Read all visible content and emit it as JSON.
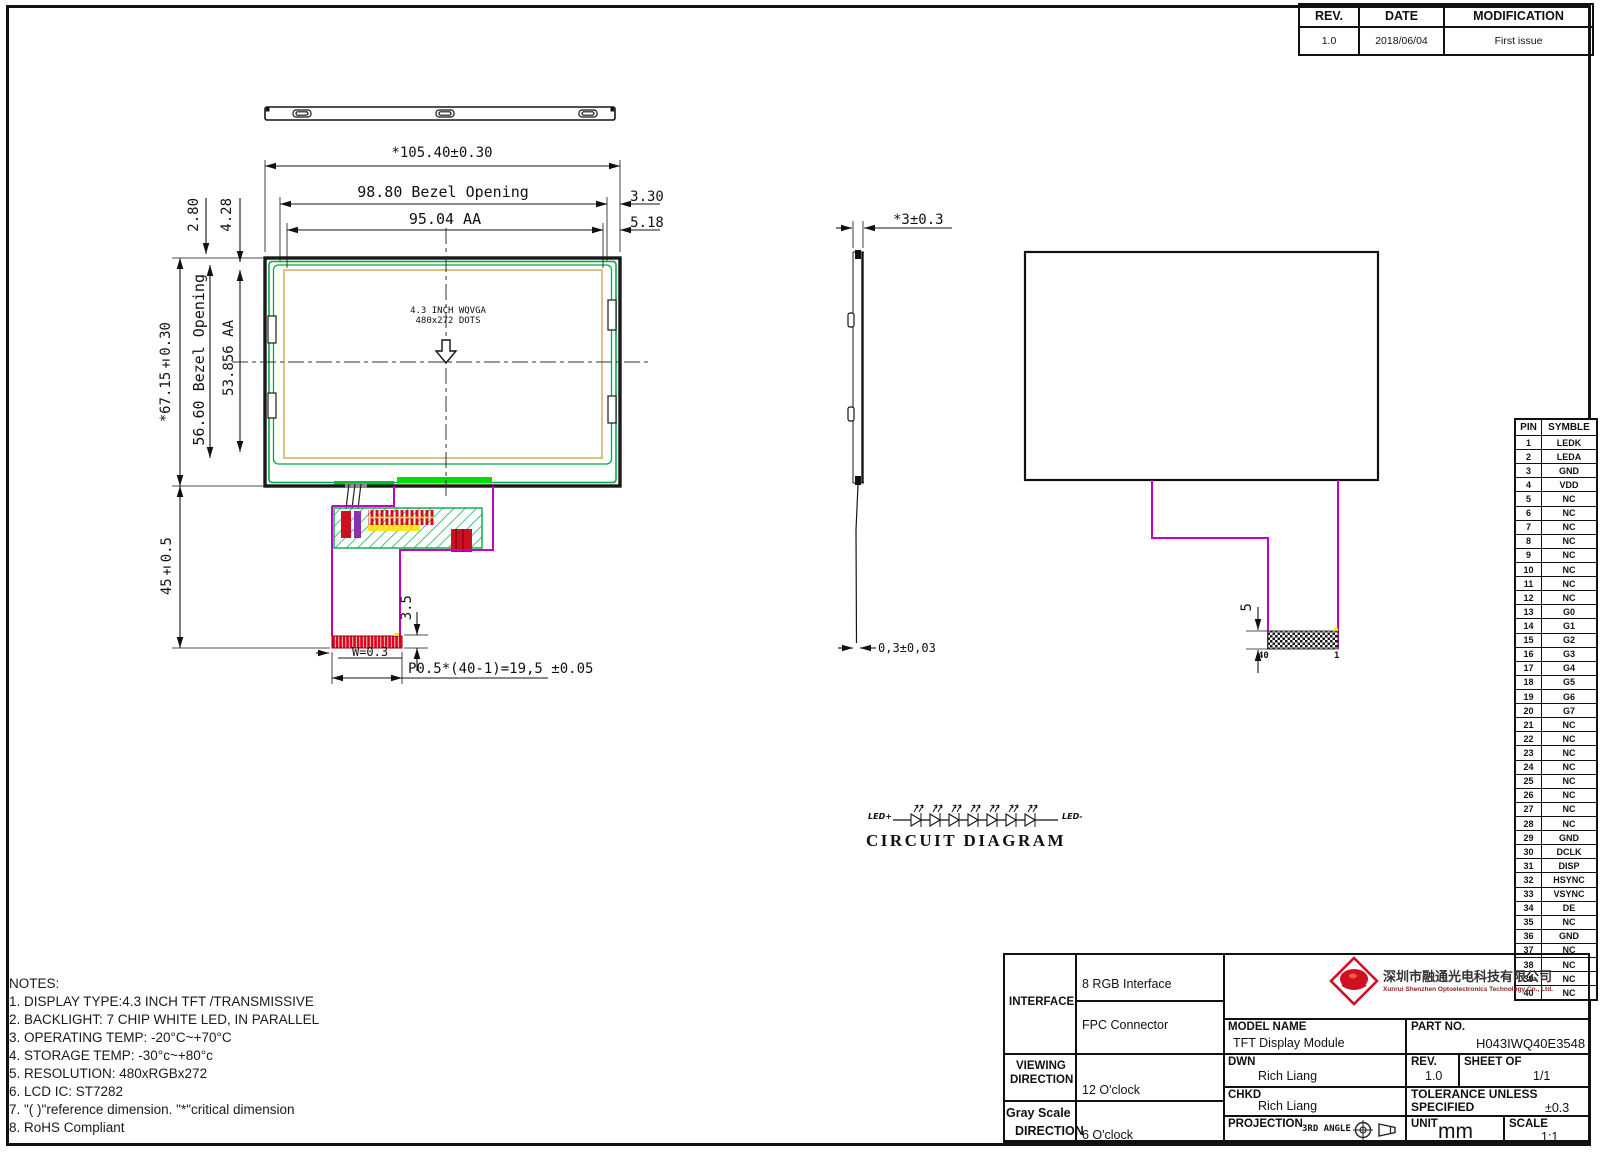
{
  "rev_table": {
    "headers": [
      "REV.",
      "DATE",
      "MODIFICATION"
    ],
    "row": {
      "rev": "1.0",
      "date": "2018/06/04",
      "modification": "First issue"
    }
  },
  "views": {
    "front": {
      "aa_text_line1": "4.3 INCH WQVGA",
      "aa_text_line2": "480x272 DOTS",
      "dim_width_total": "*105.40±0.30",
      "dim_bezel_width": "98.80 Bezel Opening",
      "dim_aa_width": "95.04 AA",
      "dim_right_top": "3.30",
      "dim_right_bottom": "5.18",
      "dim_left_top": "2.80",
      "dim_left_top2": "4.28",
      "dim_height_total": "*67.15±0.30",
      "dim_bezel_height": "56.60 Bezel Opening",
      "dim_aa_height": "53.856 AA",
      "dim_fpc_length": "45±0.5",
      "dim_fpc_tail": "3.5",
      "dim_fpc_width": "W=0.3",
      "dim_fpc_pitch": "P0.5*(40-1)=19,5 ±0.05"
    },
    "side": {
      "dim_thickness": "*3±0.3",
      "dim_fpc_thickness": "0,3±0,03"
    },
    "back": {
      "dim_connector": "5",
      "pin_left": "40",
      "pin_right": "1"
    }
  },
  "pin_table": {
    "headers": [
      "PIN",
      "SYMBLE"
    ],
    "pins": [
      "LEDK",
      "LEDA",
      "GND",
      "VDD",
      "NC",
      "NC",
      "NC",
      "NC",
      "NC",
      "NC",
      "NC",
      "NC",
      "G0",
      "G1",
      "G2",
      "G3",
      "G4",
      "G5",
      "G6",
      "G7",
      "NC",
      "NC",
      "NC",
      "NC",
      "NC",
      "NC",
      "NC",
      "NC",
      "GND",
      "DCLK",
      "DISP",
      "HSYNC",
      "VSYNC",
      "DE",
      "NC",
      "GND",
      "NC",
      "NC",
      "NC",
      "NC"
    ]
  },
  "circuit": {
    "label_left": "LED+",
    "label_right": "LED-",
    "title": "CIRCUIT DIAGRAM",
    "led_count": 7
  },
  "notes": {
    "title": "NOTES:",
    "items": [
      "1. DISPLAY TYPE:4.3 INCH TFT /TRANSMISSIVE",
      "2. BACKLIGHT: 7 CHIP WHITE LED, IN PARALLEL",
      "3. OPERATING TEMP: -20°C~+70°C",
      "4. STORAGE TEMP: -30°c~+80°c",
      "5. RESOLUTION: 480xRGBx272",
      "6. LCD IC: ST7282",
      "7. \"( )\"reference dimension. \"*\"critical dimension",
      "8. RoHS Compliant"
    ]
  },
  "title_block": {
    "interface_label": "INTERFACE",
    "interface_value1": "8 RGB Interface",
    "interface_value2": "FPC Connector",
    "viewing_label1": "VIEWING",
    "viewing_label2": "DIRECTION",
    "viewing_value": "12 O'clock",
    "gray_label1": "Gray Scale",
    "gray_label2": "DIRECTION",
    "gray_value": "6 O'clock",
    "company_cn": "深圳市融通光电科技有限公司",
    "company_en": "Xunrui Shenzhen Optoelectronics Technology Co., Ltd.",
    "model_name_label": "MODEL NAME",
    "model_name": "TFT Display Module",
    "part_no_label": "PART NO.",
    "part_no": "H043IWQ40E3548",
    "dwn_label": "DWN",
    "dwn": "Rich Liang",
    "chkd_label": "CHKD",
    "chkd": "Rich Liang",
    "rev_label": "REV.",
    "rev": "1.0",
    "sheet_label": "SHEET OF",
    "sheet": "1/1",
    "tolerance_label1": "TOLERANCE UNLESS",
    "tolerance_label2": "SPECIFIED",
    "tolerance": "±0.3",
    "projection_label": "PROJECTION",
    "projection": "3RD ANGLE",
    "unit_label": "UNIT",
    "unit": "mm",
    "scale_label": "SCALE",
    "scale": "1:1"
  },
  "colors": {
    "line": "#151515",
    "green": "#00a845",
    "bright_green": "#00e000",
    "aa_border": "#d8b060",
    "magenta": "#c400c4",
    "red": "#e00020"
  }
}
